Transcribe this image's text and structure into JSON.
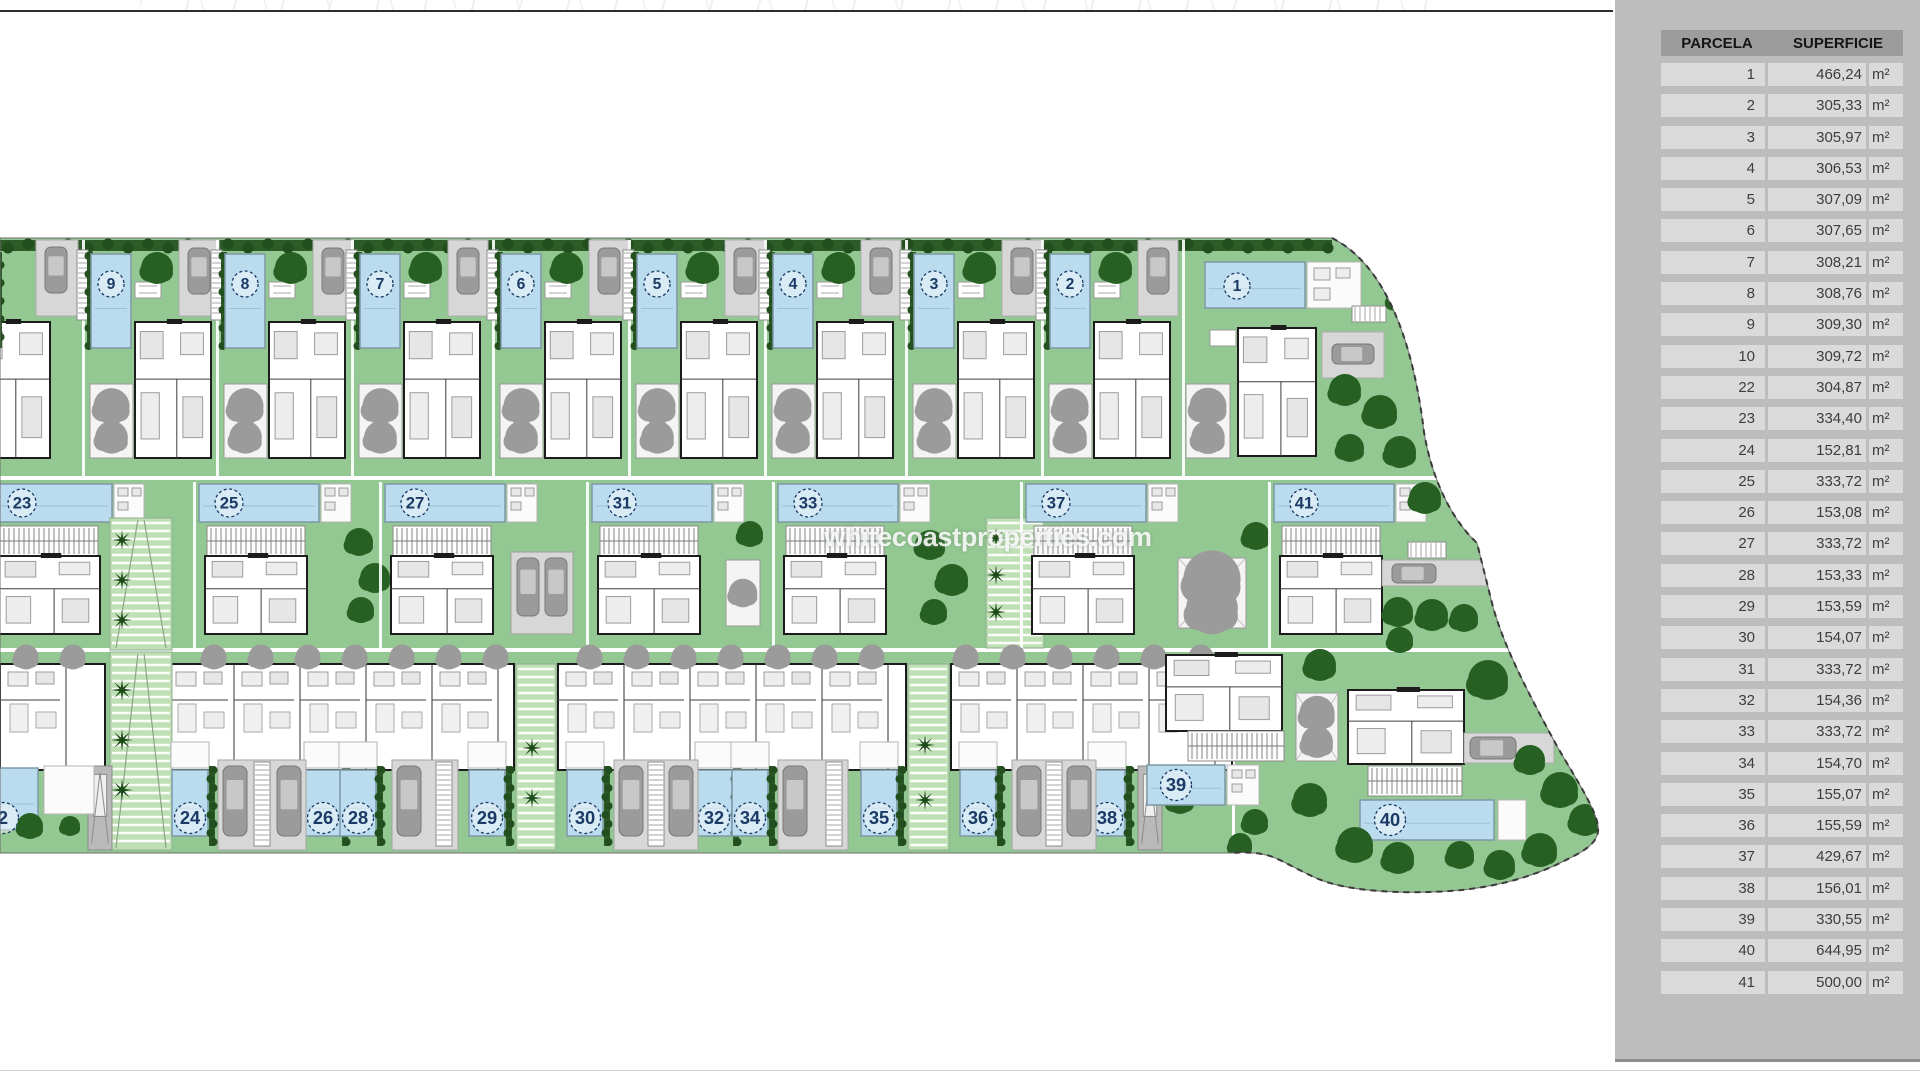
{
  "watermark_text": "whitecoastproperties.com",
  "colors": {
    "lawn": "#93c892",
    "ramp": "#bfe0b4",
    "hedge": "#2d5b28",
    "tree": "#276023",
    "palm": "#1d4a19",
    "gray_tree": "#9b9b9b",
    "pool": "#badcee",
    "navy": "#1c3a66",
    "drive": "#d7d7d7"
  },
  "table": {
    "headers": {
      "parcela": "PARCELA",
      "superficie": "SUPERFICIE"
    },
    "unit": "m²",
    "rows": [
      {
        "n": "1",
        "area": "466,24"
      },
      {
        "n": "2",
        "area": "305,33"
      },
      {
        "n": "3",
        "area": "305,97"
      },
      {
        "n": "4",
        "area": "306,53"
      },
      {
        "n": "5",
        "area": "307,09"
      },
      {
        "n": "6",
        "area": "307,65"
      },
      {
        "n": "7",
        "area": "308,21"
      },
      {
        "n": "8",
        "area": "308,76"
      },
      {
        "n": "9",
        "area": "309,30"
      },
      {
        "n": "10",
        "area": "309,72"
      },
      {
        "n": "22",
        "area": "304,87"
      },
      {
        "n": "23",
        "area": "334,40"
      },
      {
        "n": "24",
        "area": "152,81"
      },
      {
        "n": "25",
        "area": "333,72"
      },
      {
        "n": "26",
        "area": "153,08"
      },
      {
        "n": "27",
        "area": "333,72"
      },
      {
        "n": "28",
        "area": "153,33"
      },
      {
        "n": "29",
        "area": "153,59"
      },
      {
        "n": "30",
        "area": "154,07"
      },
      {
        "n": "31",
        "area": "333,72"
      },
      {
        "n": "32",
        "area": "154,36"
      },
      {
        "n": "33",
        "area": "333,72"
      },
      {
        "n": "34",
        "area": "154,70"
      },
      {
        "n": "35",
        "area": "155,07"
      },
      {
        "n": "36",
        "area": "155,59"
      },
      {
        "n": "37",
        "area": "429,67"
      },
      {
        "n": "38",
        "area": "156,01"
      },
      {
        "n": "39",
        "area": "330,55"
      },
      {
        "n": "40",
        "area": "644,95"
      },
      {
        "n": "41",
        "area": "500,00"
      }
    ]
  },
  "plan": {
    "top_row": {
      "units": [
        {
          "n": "9",
          "x": 85
        },
        {
          "n": "8",
          "x": 219
        },
        {
          "n": "7",
          "x": 354
        },
        {
          "n": "6",
          "x": 495
        },
        {
          "n": "5",
          "x": 631
        },
        {
          "n": "4",
          "x": 767
        },
        {
          "n": "3",
          "x": 908
        },
        {
          "n": "2",
          "x": 1044
        }
      ]
    },
    "villa_1": {
      "n": "1"
    },
    "middle_row": {
      "units": [
        {
          "n": "23",
          "x": -8,
          "after": "ramp"
        },
        {
          "n": "25",
          "x": 199,
          "after": "trees"
        },
        {
          "n": "27",
          "x": 385,
          "after": "cars"
        },
        {
          "n": "31",
          "x": 592,
          "after": "patio"
        },
        {
          "n": "33",
          "x": 778,
          "after": "ramp2"
        },
        {
          "n": "37",
          "x": 1026,
          "after": "patio2"
        },
        {
          "n": "41",
          "x": 1274,
          "after": "road"
        }
      ]
    },
    "bottom_row": {
      "cut_pool_label": "2",
      "pools": [
        {
          "n": "24",
          "cx": 190
        },
        {
          "n": "26",
          "cx": 323
        },
        {
          "n": "28",
          "cx": 358
        },
        {
          "n": "29",
          "cx": 487
        },
        {
          "n": "30",
          "cx": 585
        },
        {
          "n": "32",
          "cx": 714
        },
        {
          "n": "34",
          "cx": 750
        },
        {
          "n": "35",
          "cx": 879
        },
        {
          "n": "36",
          "cx": 978
        },
        {
          "n": "38",
          "cx": 1107
        }
      ]
    },
    "villa_39": {
      "n": "39"
    },
    "villa_40": {
      "n": "40"
    }
  }
}
